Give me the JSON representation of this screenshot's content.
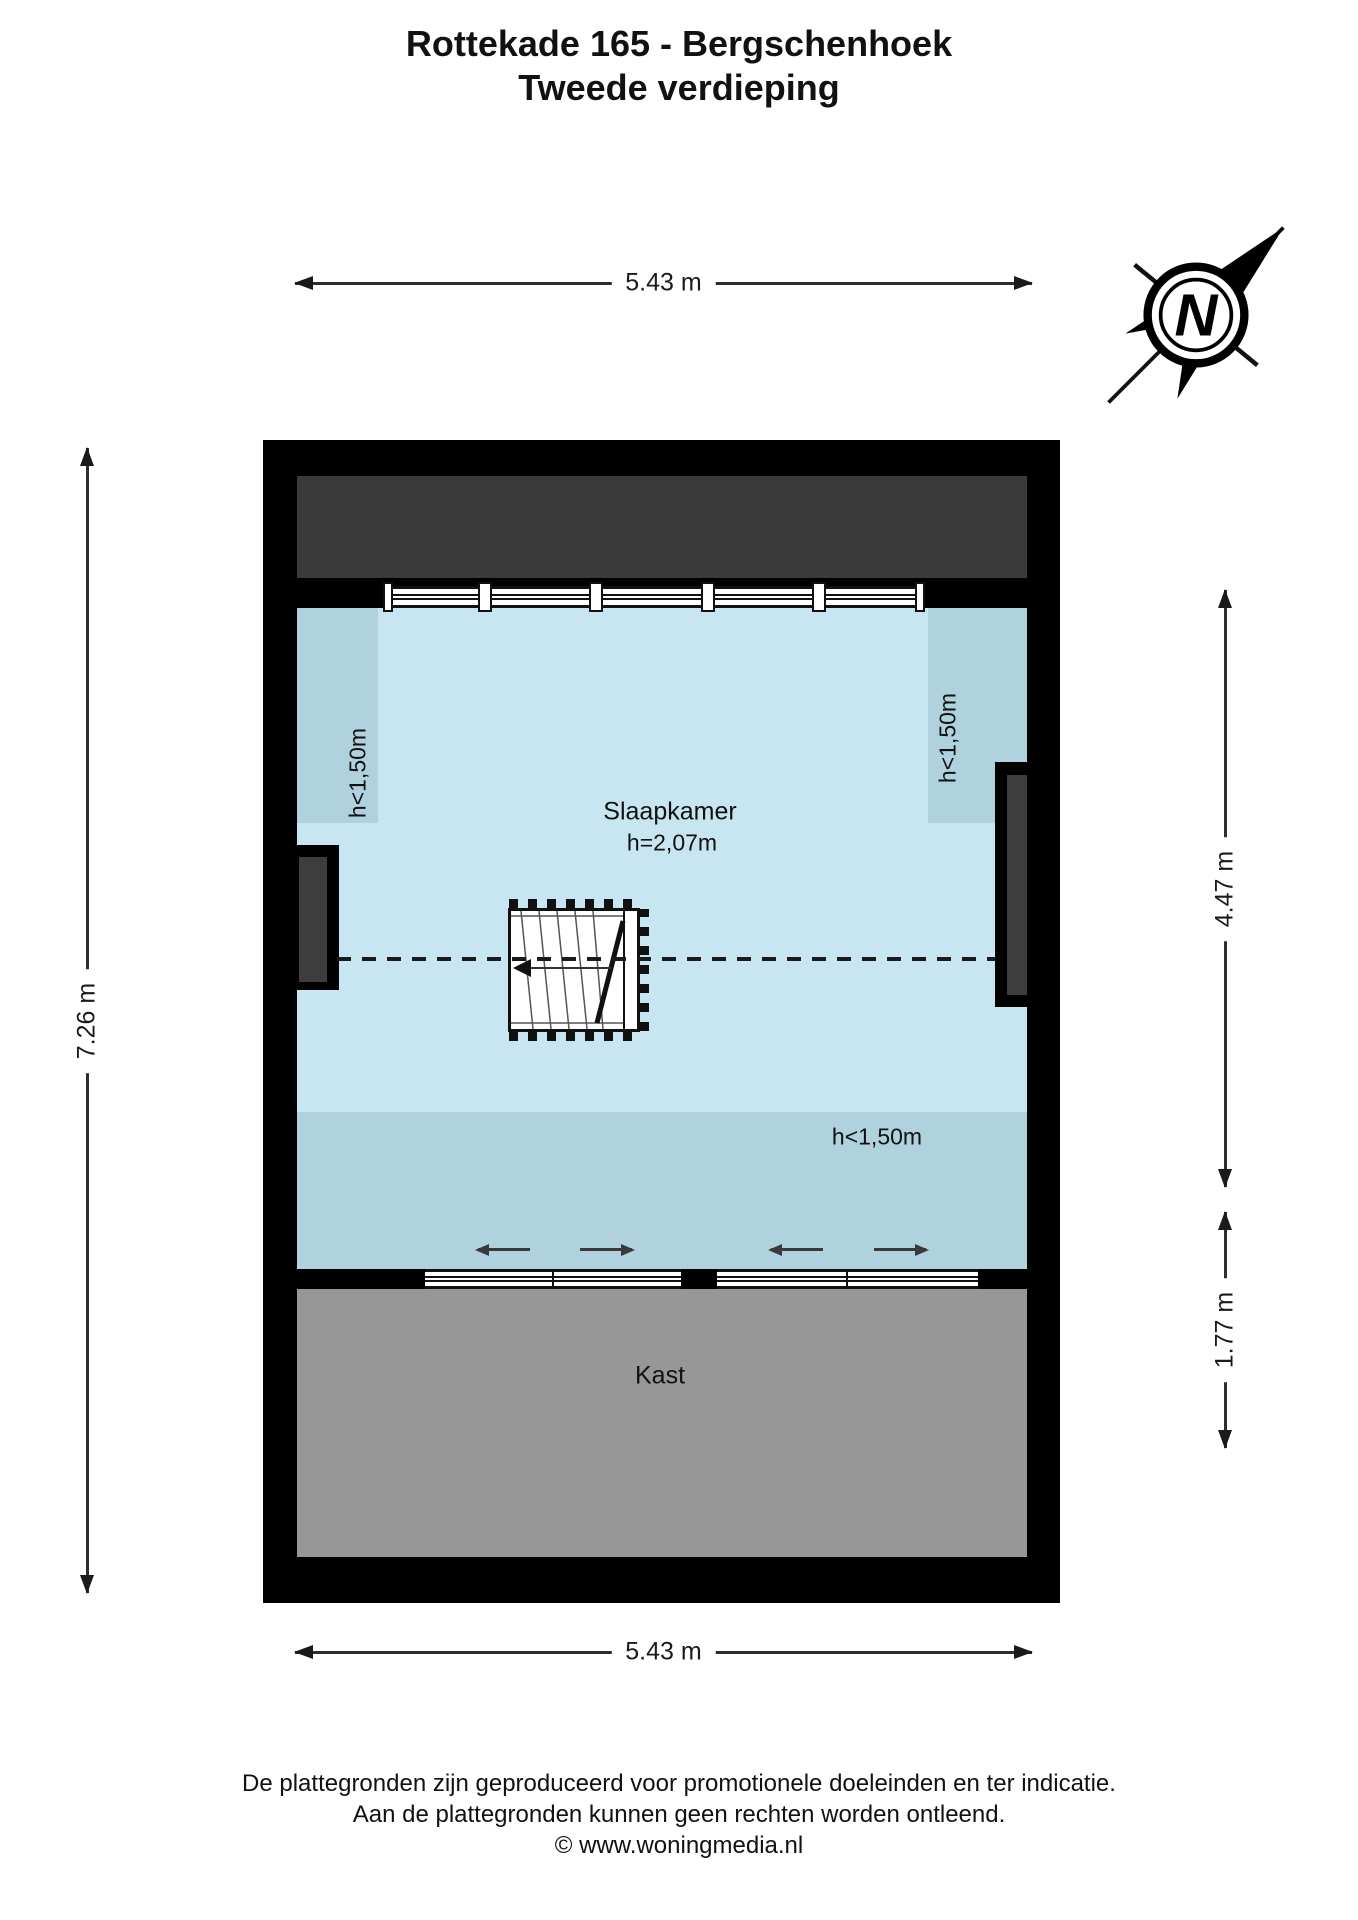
{
  "title": {
    "line1": "Rottekade 165 - Bergschenhoek",
    "line2": "Tweede verdieping"
  },
  "dimensions": {
    "top": "5.43 m",
    "bottom": "5.43 m",
    "left": "7.26 m",
    "right_upper": "4.47 m",
    "right_lower": "1.77 m"
  },
  "rooms": {
    "bedroom": {
      "name": "Slaapkamer",
      "ceiling_height": "h=2,07m"
    },
    "closet": {
      "name": "Kast"
    }
  },
  "annotations": {
    "low_ceiling_left": "h<1,50m",
    "low_ceiling_right": "h<1,50m",
    "low_ceiling_bottom": "h<1,50m"
  },
  "compass": {
    "north_letter": "N"
  },
  "icons": {
    "compass": "compass-north-icon",
    "stairs": "staircase-symbol",
    "ridge": "roof-ridge-dashed-line"
  },
  "footer": {
    "lines": [
      "De plattegronden zijn geproduceerd voor promotionele doeleinden en ter indicatie.",
      "Aan de plattegronden kunnen geen rechten worden ontleend.",
      "© www.woningmedia.nl"
    ]
  },
  "colors": {
    "wall": "#000000",
    "room_fill": "#c8e6f2",
    "low_ceiling_fill": "#b0d1de",
    "attic_dark": "#3a3a3a",
    "closet_gray": "#979797",
    "line": "#2d2d2d"
  }
}
